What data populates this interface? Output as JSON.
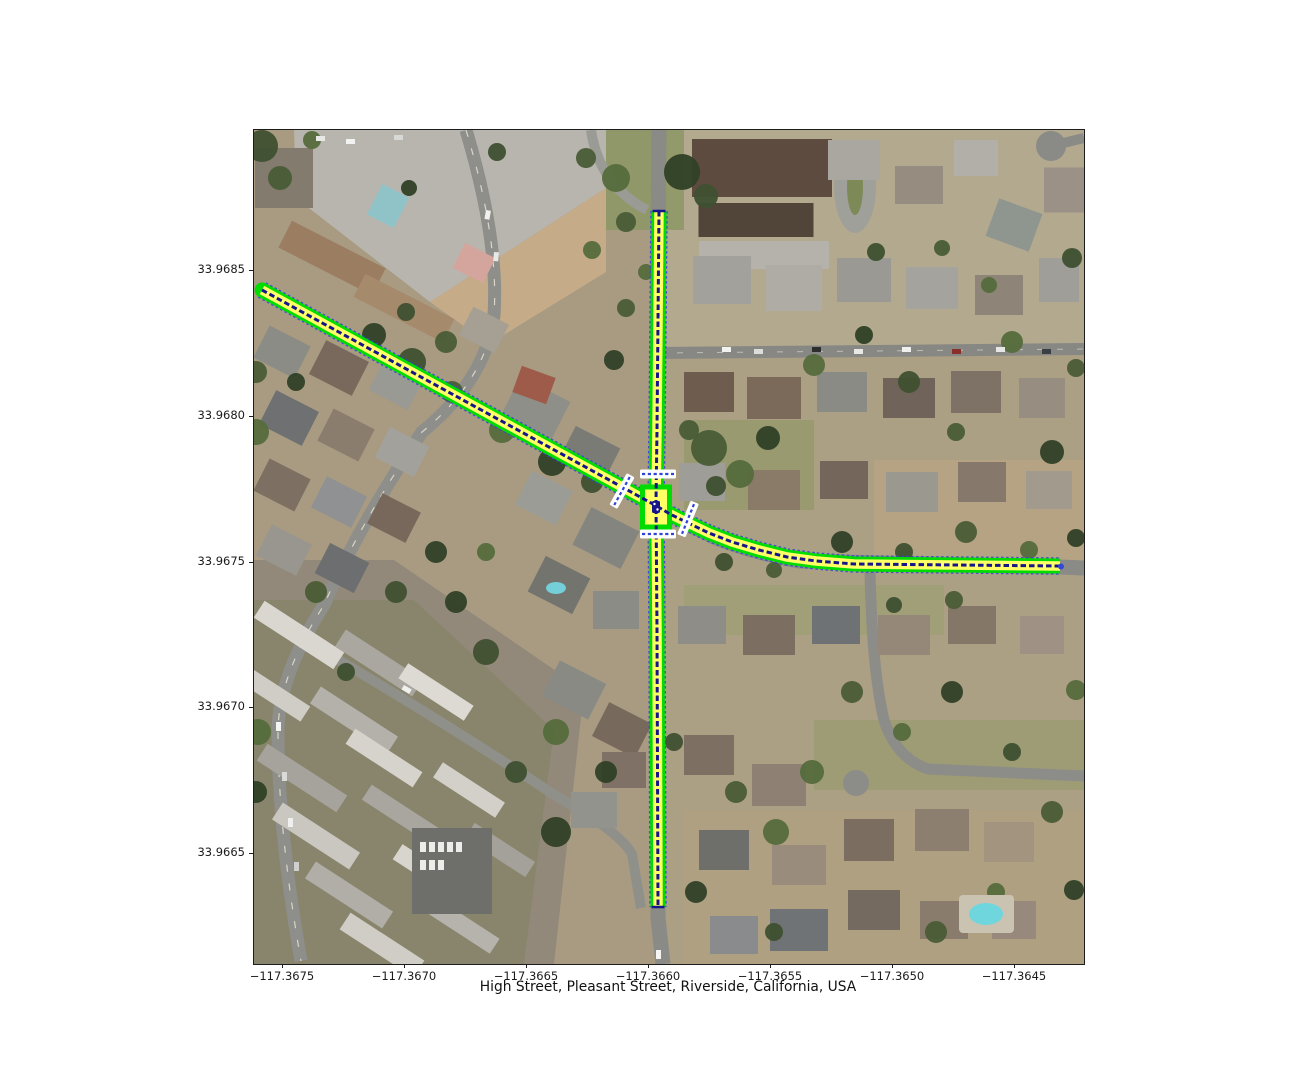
{
  "figure": {
    "title": "High Street, Pleasant Street, Riverside, California, USA",
    "x_axis": {
      "tick_labels": [
        "−117.3675",
        "−117.3670",
        "−117.3665",
        "−117.3660",
        "−117.3655",
        "−117.3650",
        "−117.3645"
      ],
      "tick_px": [
        282,
        404,
        526,
        648,
        770,
        892,
        1014
      ]
    },
    "y_axis": {
      "tick_labels": [
        "33.9685",
        "33.9680",
        "33.9675",
        "33.9670",
        "33.9665"
      ],
      "tick_px": [
        270,
        416,
        562,
        707,
        853
      ]
    }
  },
  "map": {
    "type": "satellite_route_overlay",
    "overlay_colors": {
      "casing": "#00dc00",
      "lane_fill": "#ffff66",
      "centerline": "#16168a",
      "edge_dash": "#3347d6",
      "crosswalk": "#ffffff",
      "crosswalk_dash": "#2f43d8"
    },
    "streets_plotted": [
      {
        "name": "High Street",
        "path_px": [
          [
            8,
            160
          ],
          [
            399,
            374
          ],
          [
            416,
            384
          ],
          [
            434,
            393
          ],
          [
            455,
            403
          ],
          [
            478,
            412
          ],
          [
            505,
            420
          ],
          [
            533,
            427
          ],
          [
            562,
            431
          ],
          [
            600,
            434
          ],
          [
            806,
            436
          ]
        ],
        "end_style": {
          "west": "round-cap",
          "east": "blue-dot"
        }
      },
      {
        "name": "Pleasant Street",
        "path_px": [
          [
            405,
            81
          ],
          [
            403,
            300
          ],
          [
            402,
            371
          ],
          [
            403,
            500
          ],
          [
            404,
            777
          ]
        ],
        "end_style": {
          "north": "navy-bar",
          "south": "navy-bar"
        }
      }
    ],
    "junction_box_px": {
      "x": 388.5,
      "y": 357,
      "w": 27,
      "h": 40
    },
    "junction_marker_px": {
      "x": 402,
      "y": 377
    },
    "crosswalks_px": [
      {
        "x": 404,
        "y": 344,
        "angle": 0
      },
      {
        "x": 404,
        "y": 404,
        "angle": 0
      },
      {
        "x": 368,
        "y": 361,
        "angle": 119
      },
      {
        "x": 434,
        "y": 389,
        "angle": 112
      }
    ]
  }
}
